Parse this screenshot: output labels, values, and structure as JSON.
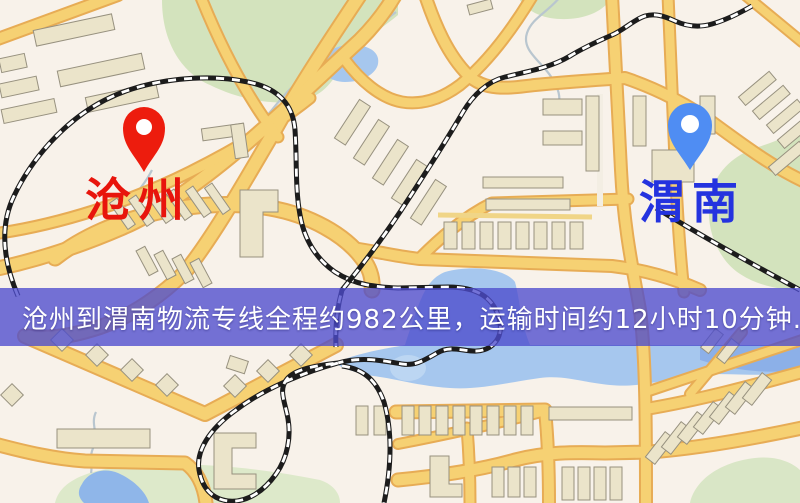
{
  "map": {
    "origin": {
      "city": "沧州",
      "label_color": "#e8150c",
      "pin_color": "#ed1c0d",
      "pin_icon": "red-map-pin"
    },
    "destination": {
      "city": "渭南",
      "label_color": "#2433df",
      "pin_color": "#4f8df3",
      "pin_icon": "blue-map-pin"
    },
    "route_banner": {
      "text": "沧州到渭南物流专线全程约982公里，运输时间约12小时10分钟.",
      "distance": "982公里",
      "duration": "12小时10分钟",
      "overlay_color": "#4d4bcd",
      "text_color": "#ffffff"
    },
    "palette": {
      "background": "#f8f2ea",
      "road": "#f6d173",
      "road_casing": "#e7ac55",
      "water": "#a6c7ee",
      "water_deep": "#8cb0e8",
      "park": "#d3e3bd",
      "building": "#ebe4ca",
      "railway": "#1c1c1c"
    }
  }
}
